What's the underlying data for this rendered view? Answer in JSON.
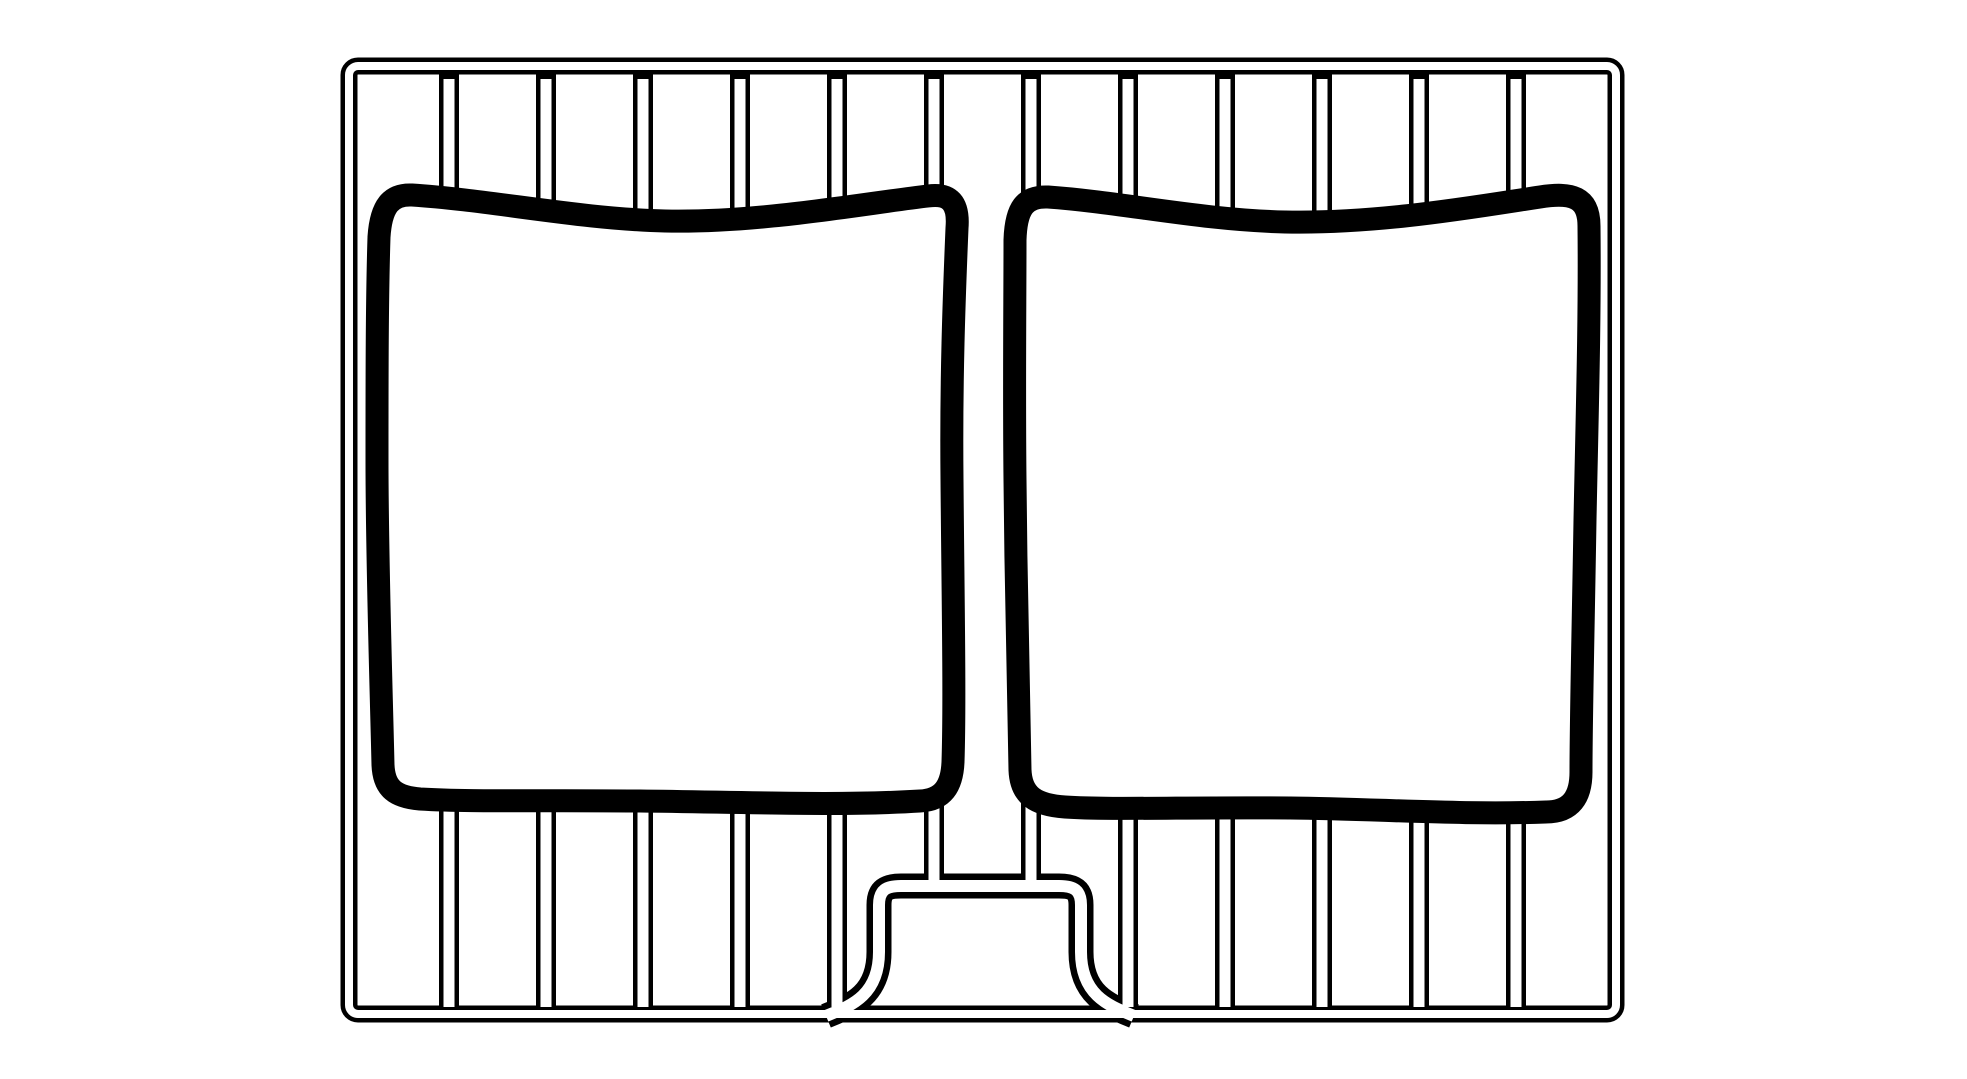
{
  "page": {
    "background_color": "#ffffff"
  },
  "illustration": {
    "description": "Black-and-white line drawing of a wire grill rack holding two slices of bread seen from the front; hollow-tube frame and rods drawn as double outlines, thick-outlined irregular rounded-square bread slices, raised handle bump on the bottom rail",
    "canvas": {
      "width": 1967,
      "height": 1079
    },
    "ink_color": "#000000",
    "paper_color": "#ffffff",
    "frame": {
      "x": 349,
      "y": 66,
      "width": 1267,
      "height": 948,
      "corner_radius": 9,
      "outline_width": 17,
      "hollow_width": 8
    },
    "bars": {
      "x_positions": [
        449,
        546,
        643,
        740,
        837,
        934,
        1031,
        1128,
        1225,
        1322,
        1419,
        1516
      ],
      "top_y": 74,
      "bottom_y": 1012,
      "hole_top_y": 79,
      "hole_bottom_y": 1007,
      "outline_width": 20,
      "hollow_width": 11,
      "short_bar_indexes": [
        5,
        6
      ],
      "short_bottom_y": 898,
      "short_hole_bottom_y": 884
    },
    "handle": {
      "path": "M 826 1016 C 850 1006 879 996 879 952 L 879 905 C 879 890 886 886 901 886 L 1059 886 C 1074 886 1081 890 1081 905 L 1081 952 C 1081 996 1110 1006 1134 1016",
      "outline_width": 25,
      "hollow_width": 12
    },
    "slice_outline_width": 23,
    "slices": [
      {
        "id": "bread-slice-left",
        "path": "M 379 237 C 381 206 391 194 412 195 C 490 200 580 219 665 221 C 760 223 860 204 928 196 C 950 193 959 203 957 228 C 954 300 951 380 952 480 C 953 600 955 700 953 762 C 952 786 943 800 920 801 C 840 806 740 802 640 801 C 540 800 470 802 420 799 C 396 797 384 789 383 765 C 381 680 377 560 377 460 C 377 380 377 300 379 237 Z"
      },
      {
        "id": "bread-slice-right",
        "path": "M 1015 240 C 1016 208 1025 196 1048 197 C 1120 202 1200 220 1285 222 C 1380 224 1480 206 1540 197 C 1572 192 1589 197 1589 226 C 1590 320 1587 420 1585 520 C 1583 640 1581 720 1581 772 C 1581 797 1571 812 1546 812 C 1460 815 1380 809 1290 808 C 1190 807 1110 810 1065 807 C 1036 805 1021 796 1020 770 C 1018 690 1016 580 1015 480 C 1014 390 1015 300 1015 240 Z"
      }
    ]
  }
}
